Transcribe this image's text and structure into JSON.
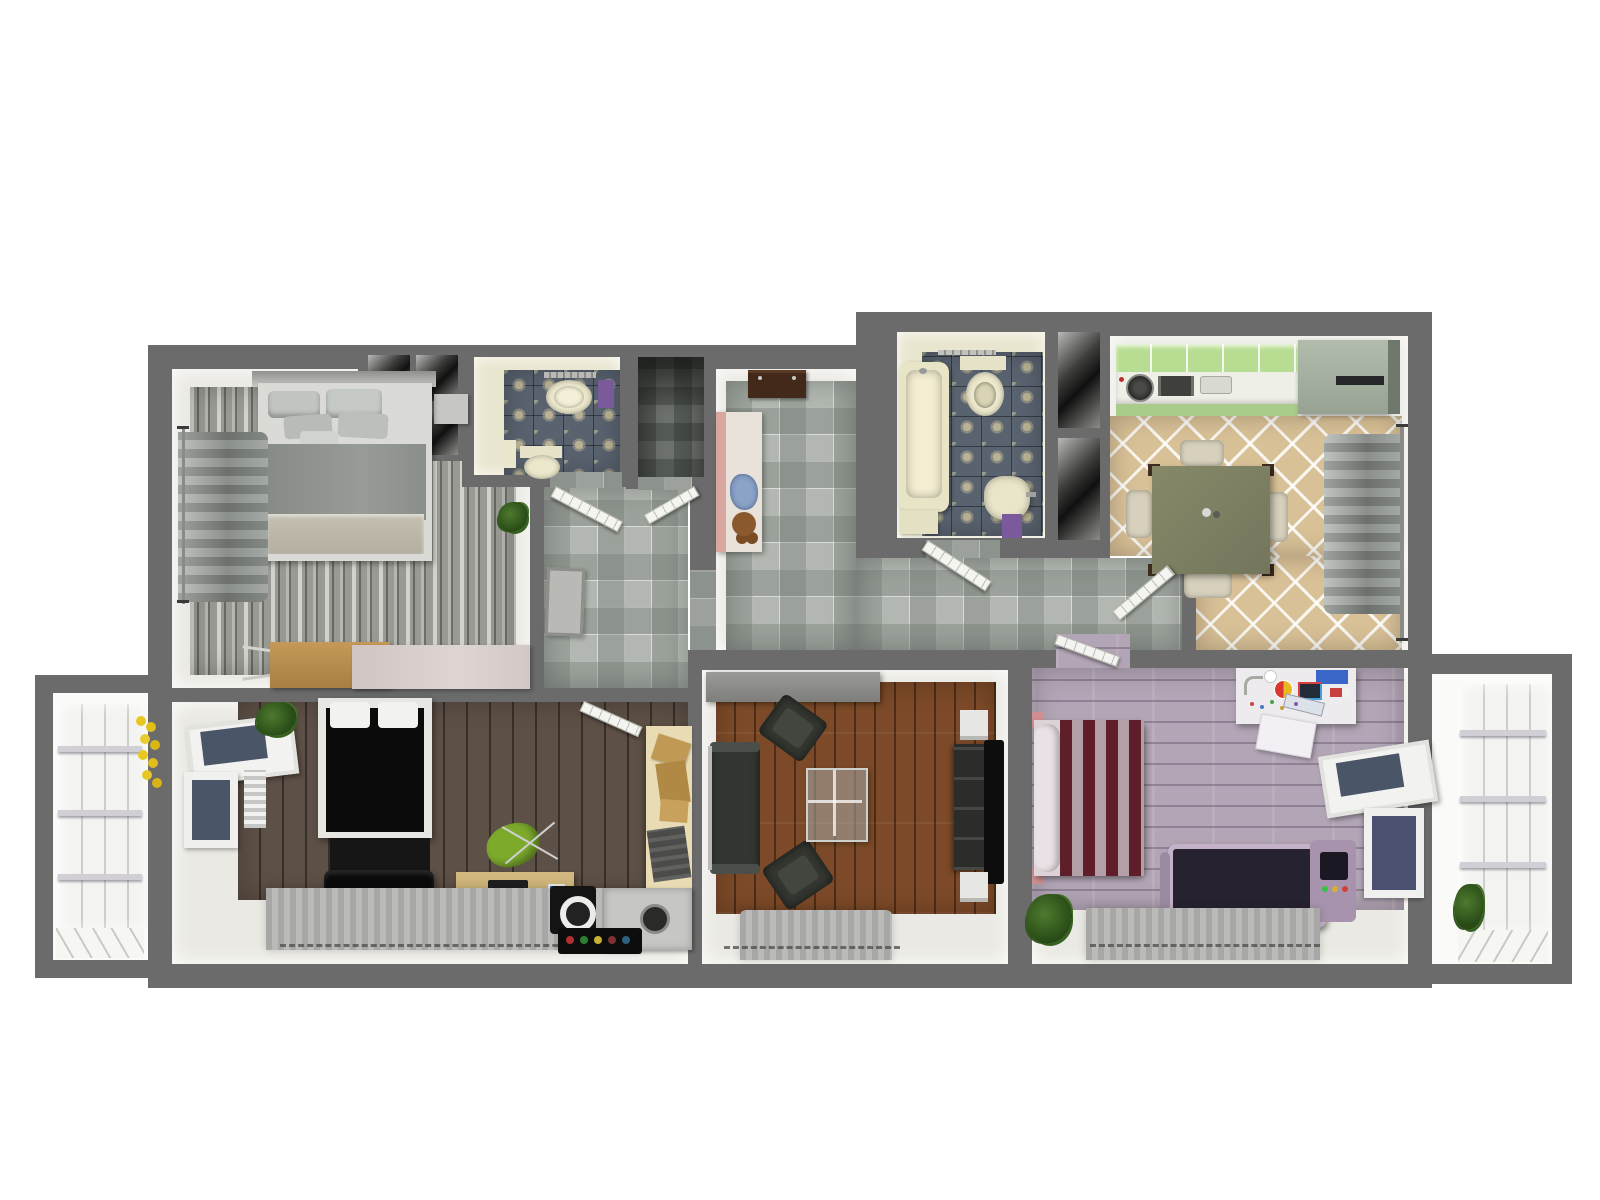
{
  "scene": {
    "type": "apartment-floor-plan-3d-top-view",
    "background": "#ffffff"
  },
  "palette": {
    "outer_wall": "#6b6b6b",
    "wall_face": "#eae9e3",
    "bathroom_wall": "#e9e6d0",
    "bathroom_tile": "#59626f",
    "bathroom_tile_motif": "#b9b294",
    "hall_tile": "#b2b8b1",
    "kitchen_tile": "#d9c197",
    "kitchen_cabinet_green": "#b7dd92",
    "kitchen_counter": "#eef0e8",
    "fridge": "#a7b2a2",
    "dining_table": "#7b7e64",
    "weathered_wood": "#9a9a94",
    "living_wood": "#7c4a28",
    "dark_wood": "#5d5046",
    "lavender_wood": "#b2a5b5",
    "sofa_dark": "#343731",
    "bed_black": "#0b0b0b",
    "bed_maroon_stripe": "#5f1f2a",
    "bed_pink_stripe": "#b3a0a6",
    "desk_wood": "#c9b078",
    "office_chair_green": "#7cab2c",
    "treadmill_frame": "#c3b2c8",
    "balcony_glass": "#f3f4f1",
    "towel_blue": "#8ca3c8",
    "towel_purple": "#7a5a9a",
    "flowers_yellow": "#e8c820",
    "teddy_brown": "#8a5a2e"
  },
  "rooms": [
    {
      "id": "bedroom-top-left",
      "label": "Bedroom with grey weathered wood floor"
    },
    {
      "id": "wc",
      "label": "Small WC with patterned tile"
    },
    {
      "id": "closet-niche",
      "label": "Closet niche"
    },
    {
      "id": "entry-hall",
      "label": "Entry hall with checkered tile"
    },
    {
      "id": "hallway",
      "label": "Hallway with checkered tile"
    },
    {
      "id": "bathroom",
      "label": "Bathroom with tub, toilet and sink"
    },
    {
      "id": "kitchen-dining",
      "label": "Kitchen and dining room"
    },
    {
      "id": "bedroom-bottom-left",
      "label": "Bedroom with dark wood floor and desk"
    },
    {
      "id": "living-room",
      "label": "Living room with sofa and TV"
    },
    {
      "id": "bedroom-bottom-right",
      "label": "Bedroom with lavender floor and treadmill"
    },
    {
      "id": "balcony-left",
      "label": "Glazed balcony (left)"
    },
    {
      "id": "balcony-right",
      "label": "Glazed balcony (right)"
    }
  ],
  "furniture": {
    "bedroom_top_left": [
      "double-bed-grey",
      "headboard-shelf",
      "wall-curtain",
      "storage-cubbies",
      "nightstand",
      "wood-desk",
      "long-cabinet",
      "potted-plant"
    ],
    "wc": [
      "toilet",
      "wash-basin",
      "towel-rail",
      "purple-towel",
      "pedestal"
    ],
    "entry_hall": [
      "console-table",
      "open-wardrobe",
      "blue-towels",
      "teddy-bear"
    ],
    "hallway": [
      "framed-picture",
      "open-doors"
    ],
    "bathroom": [
      "bathtub",
      "toilet",
      "wash-basin",
      "shelf",
      "purple-mat",
      "towel-rack"
    ],
    "kitchen_dining": [
      "green-kitchen-counter",
      "cooktop",
      "kitchen-sink",
      "fridge",
      "dining-table",
      "four-chairs",
      "window-curtain"
    ],
    "bedroom_bottom_left": [
      "double-bed-black",
      "bench",
      "black-throw",
      "desk-with-laptop",
      "green-office-chair",
      "side-desk-with-boxes",
      "printer",
      "speaker",
      "bottle-rack",
      "open-window",
      "radiator",
      "rug",
      "potted-plant"
    ],
    "living_room": [
      "sideboard",
      "sofa",
      "armchair",
      "armchair",
      "glass-coffee-table",
      "tv-console",
      "flat-tv",
      "speakers",
      "rug"
    ],
    "bedroom_bottom_right": [
      "double-bed-striped",
      "craft-desk",
      "white-chair",
      "treadmill",
      "open-window",
      "rug",
      "potted-plant"
    ],
    "balcony_left": [
      "glazed-wall",
      "yellow-flowers"
    ],
    "balcony_right": [
      "glazed-wall",
      "green-plant"
    ]
  }
}
